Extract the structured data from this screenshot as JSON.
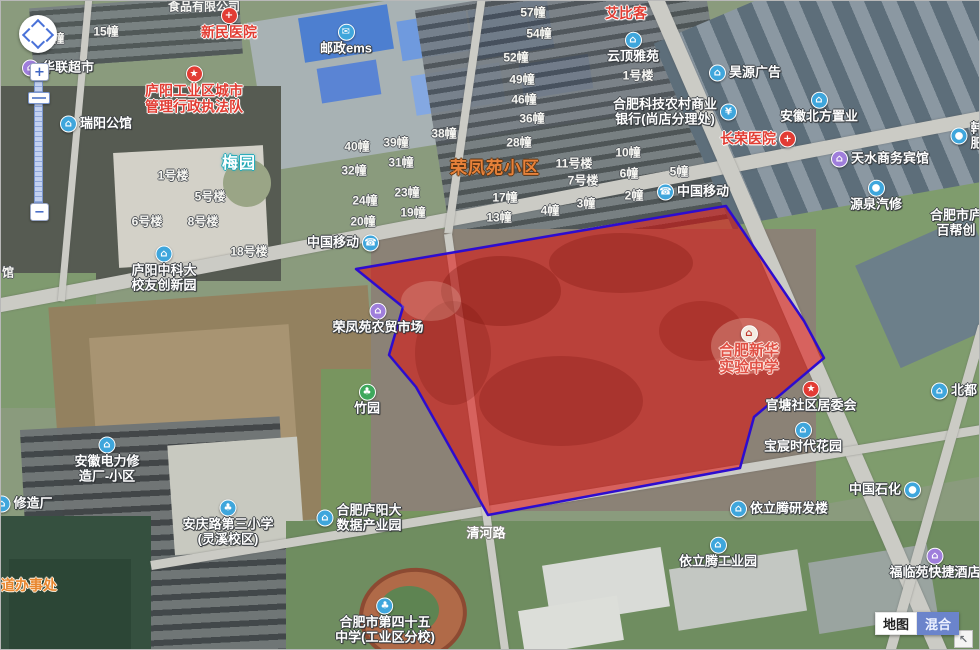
{
  "map": {
    "controls": {
      "zoom_in": "+",
      "zoom_out": "−",
      "corner": "↖"
    },
    "type_buttons": [
      {
        "name": "map-mode-button",
        "label": "地图",
        "active": false
      },
      {
        "name": "hybrid-mode-button",
        "label": "混合",
        "active": true
      }
    ],
    "region": {
      "fill": "rgba(226,12,10,0.55)",
      "stroke": "#2d0ccf",
      "points": [
        [
          355,
          268
        ],
        [
          725,
          205
        ],
        [
          803,
          320
        ],
        [
          823,
          357
        ],
        [
          753,
          416
        ],
        [
          739,
          467
        ],
        [
          487,
          514
        ],
        [
          415,
          386
        ],
        [
          388,
          354
        ],
        [
          402,
          306
        ]
      ]
    },
    "labels": [
      {
        "n": "partial-company-label",
        "t": [
          "食品有限公司"
        ],
        "x": 203,
        "y": 6,
        "s": "s-bldg",
        "a": false
      },
      {
        "n": "building-label",
        "t": [
          "4幢"
        ],
        "x": 54,
        "y": 38,
        "s": "s-bldg",
        "a": false
      },
      {
        "n": "building-label",
        "t": [
          "15幢"
        ],
        "x": 105,
        "y": 31,
        "s": "s-bldg",
        "a": false
      },
      {
        "n": "poi-hualian-supermarket",
        "t": [
          "华联超市"
        ],
        "x": 57,
        "y": 67,
        "s": "s-white",
        "a": true,
        "i": {
          "c": "c-purple",
          "g": "⌂",
          "n": "shop-icon",
          "p": "left"
        }
      },
      {
        "n": "poi-xinmin-hospital",
        "t": [
          "新民医院"
        ],
        "x": 228,
        "y": 23,
        "s": "s-red",
        "a": true,
        "i": {
          "c": "c-red",
          "g": "+",
          "n": "hospital-icon",
          "p": "above"
        }
      },
      {
        "n": "poi-post-ems",
        "t": [
          "邮政ems"
        ],
        "x": 345,
        "y": 39,
        "s": "s-white",
        "a": true,
        "i": {
          "c": "c-blue",
          "g": "✉",
          "n": "mail-icon",
          "p": "above"
        }
      },
      {
        "n": "poi-urban-enforcement",
        "t": [
          "庐阳工业区城市",
          "管理行政执法队"
        ],
        "x": 193,
        "y": 89,
        "s": "s-red",
        "a": true,
        "i": {
          "c": "c-red",
          "g": "★",
          "n": "badge-icon",
          "p": "above"
        }
      },
      {
        "n": "poi-ruiyang-mansion",
        "t": [
          "瑞阳公馆"
        ],
        "x": 95,
        "y": 123,
        "s": "s-white",
        "a": true,
        "i": {
          "c": "c-blue",
          "g": "⌂",
          "n": "building-icon",
          "p": "left"
        }
      },
      {
        "n": "area-meiyuan",
        "t": [
          "梅园"
        ],
        "x": 238,
        "y": 163,
        "s": "s-cyan",
        "a": false
      },
      {
        "n": "building-label",
        "t": [
          "1号楼"
        ],
        "x": 172,
        "y": 175,
        "s": "s-bldg",
        "a": false
      },
      {
        "n": "building-label",
        "t": [
          "5号楼"
        ],
        "x": 209,
        "y": 196,
        "s": "s-bldg",
        "a": false
      },
      {
        "n": "building-label",
        "t": [
          "6号楼"
        ],
        "x": 146,
        "y": 221,
        "s": "s-bldg",
        "a": false
      },
      {
        "n": "building-label",
        "t": [
          "8号楼"
        ],
        "x": 202,
        "y": 221,
        "s": "s-bldg",
        "a": false
      },
      {
        "n": "building-label",
        "t": [
          "18号楼"
        ],
        "x": 248,
        "y": 251,
        "s": "s-bldg",
        "a": false
      },
      {
        "n": "poi-ustc-innovation-park",
        "t": [
          "庐阳中科大",
          "校友创新园"
        ],
        "x": 163,
        "y": 268,
        "s": "s-white",
        "a": true,
        "i": {
          "c": "c-blue",
          "g": "⌂",
          "n": "building-icon",
          "p": "above"
        }
      },
      {
        "n": "partial-label-guan",
        "t": [
          "馆"
        ],
        "x": 7,
        "y": 272,
        "s": "s-bldg",
        "a": false
      },
      {
        "n": "building-label",
        "t": [
          "57幢"
        ],
        "x": 532,
        "y": 12,
        "s": "s-bldg",
        "a": false
      },
      {
        "n": "building-label",
        "t": [
          "54幢"
        ],
        "x": 538,
        "y": 33,
        "s": "s-bldg",
        "a": false
      },
      {
        "n": "building-label",
        "t": [
          "52幢"
        ],
        "x": 515,
        "y": 57,
        "s": "s-bldg",
        "a": false
      },
      {
        "n": "building-label",
        "t": [
          "49幢"
        ],
        "x": 521,
        "y": 79,
        "s": "s-bldg",
        "a": false
      },
      {
        "n": "building-label",
        "t": [
          "46幢"
        ],
        "x": 523,
        "y": 99,
        "s": "s-bldg",
        "a": false
      },
      {
        "n": "building-label",
        "t": [
          "36幢"
        ],
        "x": 531,
        "y": 118,
        "s": "s-bldg",
        "a": false
      },
      {
        "n": "building-label",
        "t": [
          "28幢"
        ],
        "x": 518,
        "y": 142,
        "s": "s-bldg",
        "a": false
      },
      {
        "n": "building-label",
        "t": [
          "38幢"
        ],
        "x": 443,
        "y": 133,
        "s": "s-bldg",
        "a": false
      },
      {
        "n": "building-label",
        "t": [
          "39幢"
        ],
        "x": 395,
        "y": 142,
        "s": "s-bldg",
        "a": false
      },
      {
        "n": "building-label",
        "t": [
          "40幢"
        ],
        "x": 356,
        "y": 146,
        "s": "s-bldg",
        "a": false
      },
      {
        "n": "building-label",
        "t": [
          "31幢"
        ],
        "x": 400,
        "y": 162,
        "s": "s-bldg",
        "a": false
      },
      {
        "n": "building-label",
        "t": [
          "32幢"
        ],
        "x": 353,
        "y": 170,
        "s": "s-bldg",
        "a": false
      },
      {
        "n": "building-label",
        "t": [
          "23幢"
        ],
        "x": 406,
        "y": 192,
        "s": "s-bldg",
        "a": false
      },
      {
        "n": "building-label",
        "t": [
          "24幢"
        ],
        "x": 364,
        "y": 200,
        "s": "s-bldg",
        "a": false
      },
      {
        "n": "building-label",
        "t": [
          "19幢"
        ],
        "x": 412,
        "y": 212,
        "s": "s-bldg",
        "a": false
      },
      {
        "n": "building-label",
        "t": [
          "20幢"
        ],
        "x": 362,
        "y": 221,
        "s": "s-bldg",
        "a": false
      },
      {
        "n": "building-label",
        "t": [
          "17幢"
        ],
        "x": 504,
        "y": 197,
        "s": "s-bldg",
        "a": false
      },
      {
        "n": "building-label",
        "t": [
          "13幢"
        ],
        "x": 498,
        "y": 217,
        "s": "s-bldg",
        "a": false
      },
      {
        "n": "building-label",
        "t": [
          "4幢"
        ],
        "x": 549,
        "y": 210,
        "s": "s-bldg",
        "a": false
      },
      {
        "n": "building-label",
        "t": [
          "3幢"
        ],
        "x": 585,
        "y": 203,
        "s": "s-bldg",
        "a": false
      },
      {
        "n": "building-label",
        "t": [
          "11号楼"
        ],
        "x": 573,
        "y": 163,
        "s": "s-bldg",
        "a": false
      },
      {
        "n": "building-label",
        "t": [
          "7号楼"
        ],
        "x": 582,
        "y": 180,
        "s": "s-bldg",
        "a": false
      },
      {
        "n": "building-label",
        "t": [
          "10幢"
        ],
        "x": 627,
        "y": 152,
        "s": "s-bldg",
        "a": false
      },
      {
        "n": "building-label",
        "t": [
          "6幢"
        ],
        "x": 628,
        "y": 173,
        "s": "s-bldg",
        "a": false
      },
      {
        "n": "building-label",
        "t": [
          "5幢"
        ],
        "x": 678,
        "y": 171,
        "s": "s-bldg",
        "a": false
      },
      {
        "n": "building-label",
        "t": [
          "2幢"
        ],
        "x": 633,
        "y": 195,
        "s": "s-bldg",
        "a": false
      },
      {
        "n": "building-label",
        "t": [
          "1号楼"
        ],
        "x": 637,
        "y": 75,
        "s": "s-bldg",
        "a": false
      },
      {
        "n": "area-rongfengyuan",
        "t": [
          "荣凤苑小区"
        ],
        "x": 494,
        "y": 167,
        "s": "s-orangebig",
        "a": false
      },
      {
        "n": "poi-aibike",
        "t": [
          "艾比客"
        ],
        "x": 625,
        "y": 13,
        "s": "s-red",
        "a": false
      },
      {
        "n": "poi-yunding-yayuan",
        "t": [
          "云顶雅苑"
        ],
        "x": 632,
        "y": 47,
        "s": "s-white",
        "a": true,
        "i": {
          "c": "c-blue",
          "g": "⌂",
          "n": "building-icon",
          "p": "above"
        }
      },
      {
        "n": "poi-haoyuan-ad",
        "t": [
          "昊源广告"
        ],
        "x": 744,
        "y": 72,
        "s": "s-white",
        "a": true,
        "i": {
          "c": "c-blue",
          "g": "⌂",
          "n": "building-icon",
          "p": "left"
        }
      },
      {
        "n": "poi-rural-bank",
        "t": [
          "合肥科技农村商业",
          "银行(尚店分理处)"
        ],
        "x": 674,
        "y": 111,
        "s": "s-white",
        "a": true,
        "i": {
          "c": "c-blue",
          "g": "¥",
          "n": "bank-icon",
          "p": "right"
        }
      },
      {
        "n": "poi-north-anhui-realty",
        "t": [
          "安徽北方置业"
        ],
        "x": 818,
        "y": 107,
        "s": "s-white",
        "a": true,
        "i": {
          "c": "c-blue",
          "g": "⌂",
          "n": "building-icon",
          "p": "above"
        }
      },
      {
        "n": "poi-changrong-hospital",
        "t": [
          "长荣医院"
        ],
        "x": 757,
        "y": 138,
        "s": "s-red",
        "a": true,
        "i": {
          "c": "c-red",
          "g": "+",
          "n": "hospital-icon",
          "p": "right"
        }
      },
      {
        "n": "poi-tianshui-hotel",
        "t": [
          "天水商务宾馆"
        ],
        "x": 879,
        "y": 158,
        "s": "s-white",
        "a": true,
        "i": {
          "c": "c-purple",
          "g": "⌂",
          "n": "hotel-icon",
          "p": "left"
        }
      },
      {
        "n": "poi-china-mobile-north",
        "t": [
          "中国移动"
        ],
        "x": 692,
        "y": 191,
        "s": "s-white",
        "a": true,
        "i": {
          "c": "c-blue",
          "g": "☎",
          "n": "phone-icon",
          "p": "left"
        }
      },
      {
        "n": "poi-yuanquan-autorepair",
        "t": [
          "源泉汽修"
        ],
        "x": 875,
        "y": 195,
        "s": "s-white",
        "a": true,
        "i": {
          "c": "c-blue",
          "g": "●",
          "n": "car-icon",
          "p": "above"
        }
      },
      {
        "n": "partial-poi-right-edge",
        "t": [
          "韩",
          "肥"
        ],
        "x": 966,
        "y": 135,
        "s": "s-white",
        "a": true,
        "i": {
          "c": "c-blue",
          "g": "●",
          "n": "car-icon",
          "p": "left"
        }
      },
      {
        "n": "partial-poi-baibang",
        "t": [
          "合肥市庐",
          "百帮创"
        ],
        "x": 955,
        "y": 222,
        "s": "s-white",
        "a": false
      },
      {
        "n": "poi-china-mobile-west",
        "t": [
          "中国移动"
        ],
        "x": 342,
        "y": 242,
        "s": "s-white",
        "a": true,
        "i": {
          "c": "c-blue",
          "g": "☎",
          "n": "phone-icon",
          "p": "right"
        }
      },
      {
        "n": "poi-farmers-market",
        "t": [
          "荣凤苑农贸市场"
        ],
        "x": 377,
        "y": 318,
        "s": "s-white",
        "a": true,
        "i": {
          "c": "c-purple",
          "g": "⌂",
          "n": "market-icon",
          "p": "above"
        }
      },
      {
        "n": "poi-zhuyuan-park",
        "t": [
          "竹园"
        ],
        "x": 366,
        "y": 399,
        "s": "s-white",
        "a": true,
        "i": {
          "c": "c-green",
          "g": "♣",
          "n": "tree-icon",
          "p": "above"
        }
      },
      {
        "n": "poi-xinhua-school",
        "t": [
          "合肥新华",
          "实验中学"
        ],
        "x": 748,
        "y": 350,
        "s": "s-schoolred",
        "a": true,
        "i": {
          "c": "c-school",
          "g": "⌂",
          "n": "school-icon",
          "p": "above"
        }
      },
      {
        "n": "poi-guantang-committee",
        "t": [
          "官塘社区居委会"
        ],
        "x": 810,
        "y": 396,
        "s": "s-white",
        "a": true,
        "i": {
          "c": "c-red",
          "g": "★",
          "n": "star-icon",
          "p": "above"
        }
      },
      {
        "n": "poi-baochen-garden",
        "t": [
          "宝宸时代花园"
        ],
        "x": 802,
        "y": 437,
        "s": "s-white",
        "a": true,
        "i": {
          "c": "c-blue",
          "g": "⌂",
          "n": "building-icon",
          "p": "above"
        }
      },
      {
        "n": "partial-poi-beidu",
        "t": [
          "北都"
        ],
        "x": 953,
        "y": 390,
        "s": "s-white",
        "a": true,
        "i": {
          "c": "c-blue",
          "g": "⌂",
          "n": "building-icon",
          "p": "left"
        }
      },
      {
        "n": "poi-electric-repair-estate",
        "t": [
          "安徽电力修",
          "造厂-小区"
        ],
        "x": 106,
        "y": 459,
        "s": "s-white",
        "a": true,
        "i": {
          "c": "c-blue",
          "g": "⌂",
          "n": "building-icon",
          "p": "above"
        }
      },
      {
        "n": "partial-poi-xiuzaochang",
        "t": [
          "修造厂"
        ],
        "x": 22,
        "y": 503,
        "s": "s-white",
        "a": true,
        "i": {
          "c": "c-blue",
          "g": "⌂",
          "n": "building-icon",
          "p": "left"
        }
      },
      {
        "n": "partial-area-street-office",
        "t": [
          "道办事处"
        ],
        "x": 28,
        "y": 585,
        "s": "s-orange",
        "a": false
      },
      {
        "n": "poi-anqinglu-primary-school",
        "t": [
          "安庆路第三小学",
          "(灵溪校区)"
        ],
        "x": 227,
        "y": 522,
        "s": "s-white",
        "a": true,
        "i": {
          "c": "c-blue",
          "g": "♣",
          "n": "school-icon",
          "p": "above"
        }
      },
      {
        "n": "poi-bigdata-park",
        "t": [
          "合肥庐阳大",
          "数据产业园"
        ],
        "x": 358,
        "y": 517,
        "s": "s-white",
        "a": true,
        "i": {
          "c": "c-blue",
          "g": "⌂",
          "n": "building-icon",
          "p": "left"
        }
      },
      {
        "n": "road-qinghe-road",
        "t": [
          "清河路"
        ],
        "x": 485,
        "y": 533,
        "s": "s-road",
        "a": false
      },
      {
        "n": "poi-no45-middle-school",
        "t": [
          "合肥市第四十五",
          "中学(工业区分校)"
        ],
        "x": 384,
        "y": 620,
        "s": "s-white",
        "a": true,
        "i": {
          "c": "c-blue",
          "g": "♣",
          "n": "school-icon",
          "p": "above"
        }
      },
      {
        "n": "poi-yiliteng-rd-building",
        "t": [
          "依立腾研发楼"
        ],
        "x": 778,
        "y": 508,
        "s": "s-white",
        "a": true,
        "i": {
          "c": "c-blue",
          "g": "⌂",
          "n": "building-icon",
          "p": "left"
        }
      },
      {
        "n": "poi-yiliteng-industrial-park",
        "t": [
          "依立腾工业园"
        ],
        "x": 717,
        "y": 552,
        "s": "s-white",
        "a": true,
        "i": {
          "c": "c-blue",
          "g": "⌂",
          "n": "building-icon",
          "p": "above"
        }
      },
      {
        "n": "poi-sinopec",
        "t": [
          "中国石化"
        ],
        "x": 884,
        "y": 489,
        "s": "s-white",
        "a": true,
        "i": {
          "c": "c-blue",
          "g": "●",
          "n": "fuel-icon",
          "p": "right"
        }
      },
      {
        "n": "poi-fulinyuan-hotel",
        "t": [
          "福临苑快捷酒店"
        ],
        "x": 934,
        "y": 563,
        "s": "s-white",
        "a": true,
        "i": {
          "c": "c-purple",
          "g": "⌂",
          "n": "hotel-icon",
          "p": "above"
        }
      }
    ]
  }
}
